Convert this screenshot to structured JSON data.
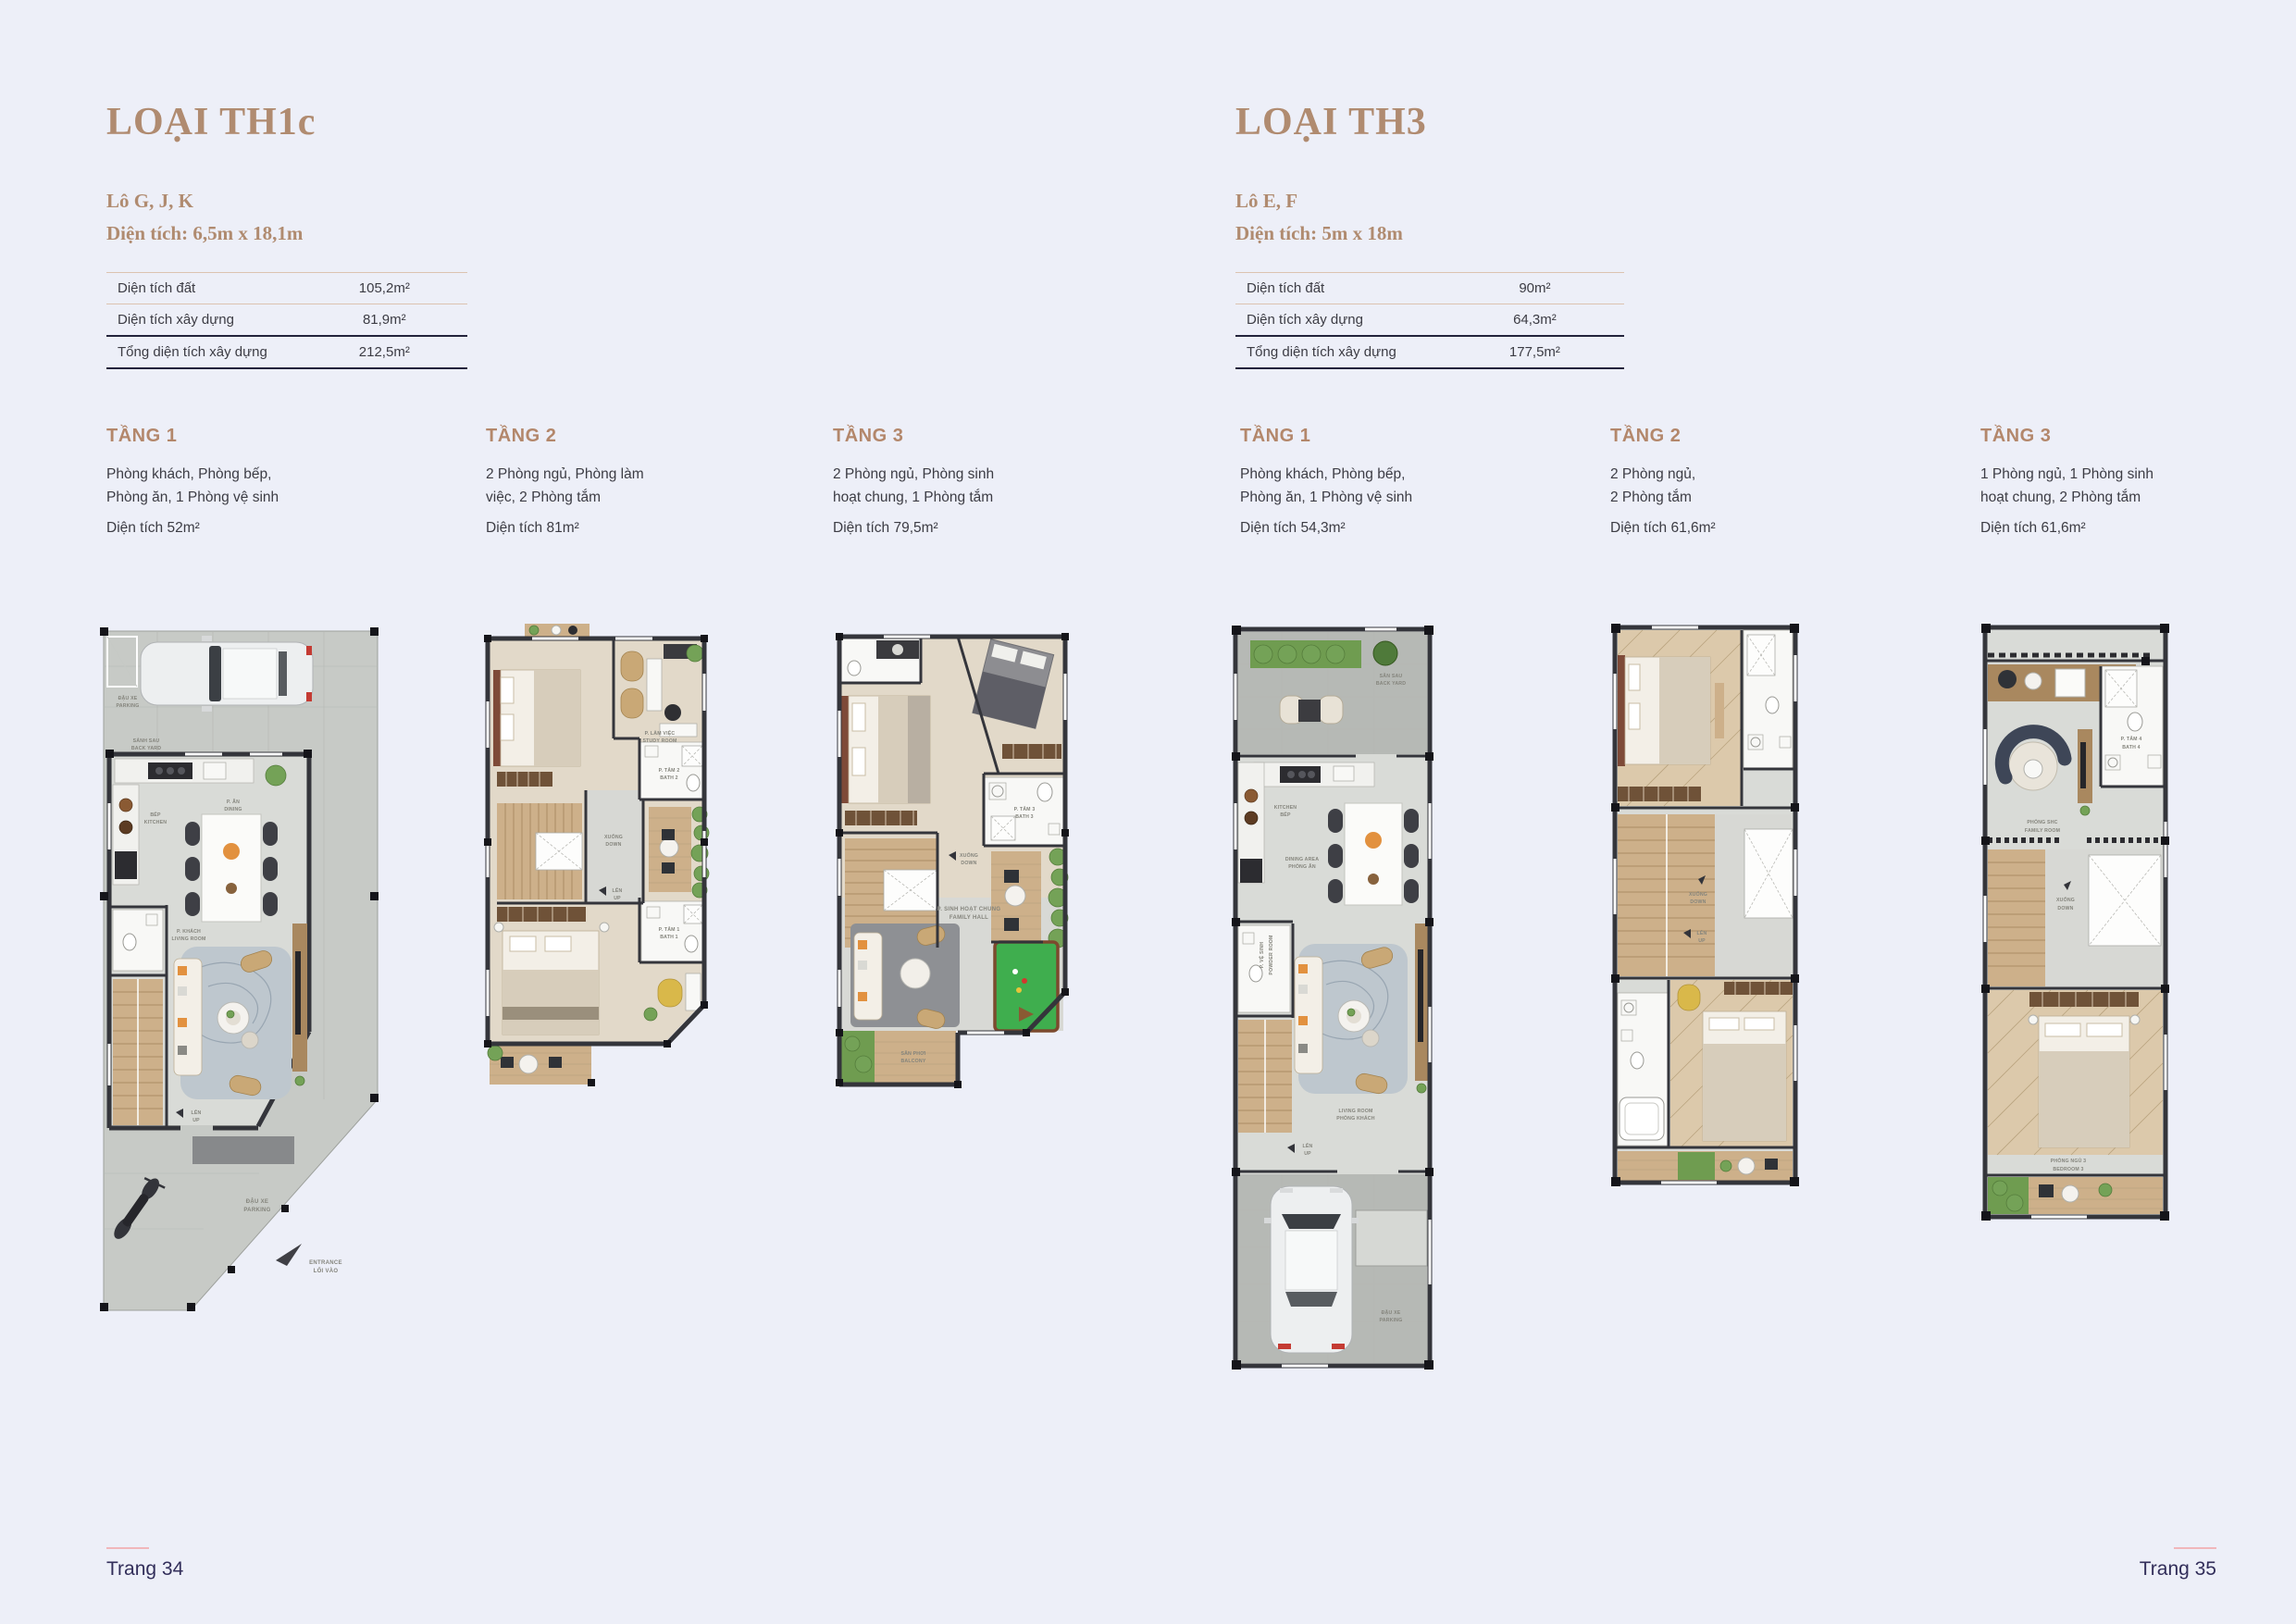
{
  "page": {
    "background": "#edeff8",
    "footer_left": "Trang 34",
    "footer_right": "Trang 35"
  },
  "colors": {
    "accent_brown": "#b08b70",
    "heading_brown": "#b3876b",
    "text_dark": "#3c3c44",
    "footer_navy": "#322e5a",
    "footer_line_pink": "#f1b7bb",
    "table_line_tan": "#dcc3b0",
    "table_line_dark": "#23233c"
  },
  "sections": [
    {
      "title": "LOẠI TH1c",
      "lot": "Lô G, J, K",
      "dimensions": "Diện tích: 6,5m x 18,1m",
      "table": [
        {
          "label": "Diện tích đất",
          "value": "105,2m²"
        },
        {
          "label": "Diện tích xây dựng",
          "value": "81,9m²"
        },
        {
          "label": "Tổng diện tích xây dựng",
          "value": "212,5m²"
        }
      ],
      "floors": [
        {
          "name": "TẦNG 1",
          "desc1": "Phòng khách, Phòng bếp,",
          "desc2": "Phòng ăn, 1 Phòng vệ sinh",
          "area": "Diện tích 52m²"
        },
        {
          "name": "TẦNG 2",
          "desc1": "2 Phòng ngủ, Phòng làm",
          "desc2": "việc, 2 Phòng tắm",
          "area": "Diện tích 81m²"
        },
        {
          "name": "TẦNG 3",
          "desc1": "2 Phòng ngủ, Phòng sinh",
          "desc2": "hoạt chung, 1 Phòng tắm",
          "area": "Diện tích 79,5m²"
        }
      ]
    },
    {
      "title": "LOẠI TH3",
      "lot": "Lô E, F",
      "dimensions": "Diện tích: 5m x 18m",
      "table": [
        {
          "label": "Diện tích đất",
          "value": "90m²"
        },
        {
          "label": "Diện tích xây dựng",
          "value": "64,3m²"
        },
        {
          "label": "Tổng diện tích xây dựng",
          "value": "177,5m²"
        }
      ],
      "floors": [
        {
          "name": "TẦNG 1",
          "desc1": "Phòng khách, Phòng bếp,",
          "desc2": "Phòng ăn, 1 Phòng vệ sinh",
          "area": "Diện tích 54,3m²"
        },
        {
          "name": "TẦNG 2",
          "desc1": "2 Phòng ngủ,",
          "desc2": "2 Phòng tắm",
          "area": "Diện tích 61,6m²"
        },
        {
          "name": "TẦNG 3",
          "desc1": "1 Phòng ngủ, 1 Phòng sinh",
          "desc2": "hoạt chung, 2 Phòng tắm",
          "area": "Diện tích 61,6m²"
        }
      ]
    }
  ],
  "plans": [
    {
      "labels": {
        "car": [
          "ĐẬU XE",
          "PARKING"
        ],
        "back": [
          "SẢNH SAU",
          "BACK YARD"
        ],
        "kitchen": [
          "BẾP",
          "KITCHEN"
        ],
        "dining": [
          "P. ĂN",
          "DINING"
        ],
        "living": [
          "P. KHÁCH",
          "LIVING ROOM"
        ],
        "up": [
          "LÊN",
          "UP"
        ],
        "parking": [
          "ĐẬU XE",
          "PARKING"
        ],
        "entrance": [
          "ENTRANCE",
          "LỐI VÀO"
        ]
      }
    },
    {
      "labels": {
        "study": [
          "P. LÀM VIỆC",
          "STUDY ROOM"
        ],
        "bath2": [
          "P. TẮM 2",
          "BATH 2"
        ],
        "down": [
          "XUỐNG",
          "DOWN"
        ],
        "up": [
          "LÊN",
          "UP"
        ],
        "bath1": [
          "P. TẮM 1",
          "BATH 1"
        ]
      }
    },
    {
      "labels": {
        "bath3": [
          "P. TẮM 3",
          "BATH 3"
        ],
        "down": [
          "XUỐNG",
          "DOWN"
        ],
        "family": [
          "P. SINH HOẠT CHUNG",
          "FAMILY HALL"
        ],
        "balcony": [
          "SÂN PHƠI",
          "BALCONY"
        ]
      }
    },
    {
      "labels": {
        "back": [
          "SÂN SAU",
          "BACK YARD"
        ],
        "kitchen": [
          "KITCHEN",
          "BẾP"
        ],
        "dining": [
          "DINING AREA",
          "PHÒNG ĂN"
        ],
        "powder": [
          "P. VỆ SINH",
          "POWDER ROOM"
        ],
        "living": [
          "LIVING ROOM",
          "PHÒNG KHÁCH"
        ],
        "up": [
          "LÊN",
          "UP"
        ],
        "parking": [
          "ĐẬU XE",
          "PARKING"
        ]
      }
    },
    {
      "labels": {
        "down": [
          "XUỐNG",
          "DOWN"
        ],
        "up": [
          "LÊN",
          "UP"
        ]
      }
    },
    {
      "labels": {
        "bath4": [
          "P. TẮM 4",
          "BATH 4"
        ],
        "family": [
          "PHÒNG SHC",
          "FAMILY ROOM"
        ],
        "down": [
          "XUỐNG",
          "DOWN"
        ],
        "bedroom3": [
          "PHÒNG NGỦ 3",
          "BEDROOM 3"
        ]
      }
    }
  ]
}
